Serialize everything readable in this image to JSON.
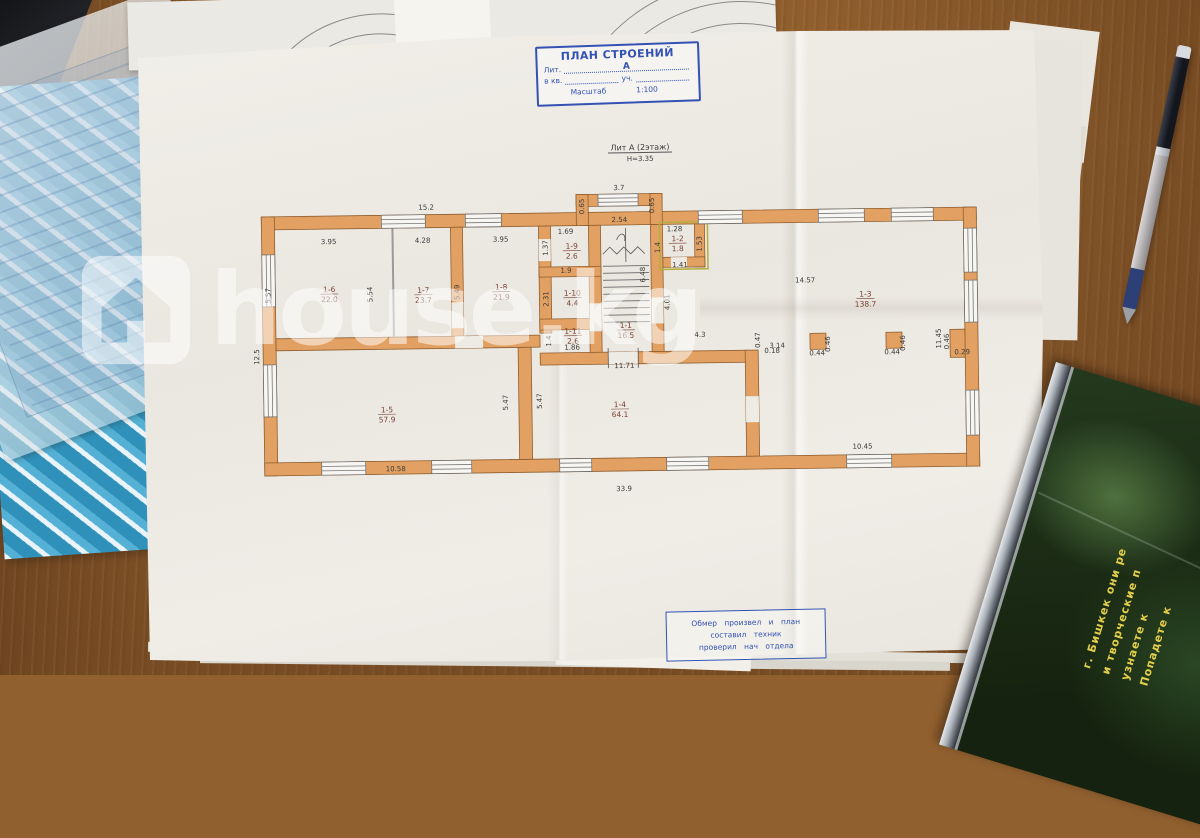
{
  "colors": {
    "wall_orange": "#E2A163",
    "ink_blue": "#3352B4",
    "dimension_text": "#3B3B3B",
    "room_text": "#7A4034",
    "folder_blue": "#2F91BA",
    "cd_text_yellow": "#E3CF4B",
    "desk_wood": "#91602F",
    "watermark_white": "rgba(255,255,255,0.52)"
  },
  "watermark": {
    "text": "house.kg",
    "icon": "house-icon"
  },
  "title_block": {
    "title": "ПЛАН СТРОЕНИЙ",
    "lit_label": "Лит.",
    "lit_value": "А",
    "kv_label": "в кв.",
    "uch_label": "уч.",
    "scale_label": "Масштаб",
    "scale_value": "1:100"
  },
  "plan_heading": {
    "line1": "Лит А (2этаж)",
    "line2": "Н=3.35"
  },
  "footer_block": {
    "line1": "Обмер произвел и план",
    "line2": "составил техник",
    "line3": "проверил нач отдела"
  },
  "cd_case": {
    "lines": [
      "Попадете к",
      "узнаете к",
      "и творческие п",
      "г. Бишкек они ре"
    ]
  },
  "plan": {
    "rooms": [
      {
        "id": "1-6",
        "area": "22.0",
        "x": 330,
        "y": 289
      },
      {
        "id": "1-7",
        "area": "23.7",
        "x": 424,
        "y": 291
      },
      {
        "id": "1-8",
        "area": "21.9",
        "x": 502,
        "y": 289
      },
      {
        "id": "1-9",
        "area": "2.6",
        "x": 573,
        "y": 249
      },
      {
        "id": "1-10",
        "area": "4.4",
        "x": 573,
        "y": 296
      },
      {
        "id": "1-11",
        "area": "2.6",
        "x": 573,
        "y": 334
      },
      {
        "id": "1-1",
        "area": "16.5",
        "x": 626,
        "y": 329
      },
      {
        "id": "1-2",
        "area": "1.8",
        "x": 679,
        "y": 243
      },
      {
        "id": "1-3",
        "area": "138.7",
        "x": 866,
        "y": 301
      },
      {
        "id": "1-5",
        "area": "57.9",
        "x": 386,
        "y": 410
      },
      {
        "id": "1-4",
        "area": "64.1",
        "x": 619,
        "y": 408
      }
    ],
    "dimensions": [
      {
        "t": "15.2",
        "x": 428,
        "y": 207,
        "r": 0
      },
      {
        "t": "3.7",
        "x": 621,
        "y": 190,
        "r": 0
      },
      {
        "t": "0.65",
        "x": 586,
        "y": 206,
        "r": -90
      },
      {
        "t": "0.65",
        "x": 656,
        "y": 206,
        "r": -90
      },
      {
        "t": "2.54",
        "x": 621,
        "y": 222,
        "r": 0
      },
      {
        "t": "3.95",
        "x": 330,
        "y": 240,
        "r": 0
      },
      {
        "t": "4.28",
        "x": 424,
        "y": 240,
        "r": 0
      },
      {
        "t": "3.95",
        "x": 502,
        "y": 240,
        "r": 0
      },
      {
        "t": "1.69",
        "x": 567,
        "y": 233,
        "r": 0
      },
      {
        "t": "1.37",
        "x": 549,
        "y": 247,
        "r": -90
      },
      {
        "t": "1.9",
        "x": 567,
        "y": 272,
        "r": 0
      },
      {
        "t": "2.31",
        "x": 549,
        "y": 298,
        "r": -90
      },
      {
        "t": "5.57",
        "x": 271,
        "y": 291,
        "r": -90
      },
      {
        "t": "5.54",
        "x": 373,
        "y": 291,
        "r": -90
      },
      {
        "t": "5.49",
        "x": 460,
        "y": 290,
        "r": -90
      },
      {
        "t": "12.5",
        "x": 259,
        "y": 352,
        "r": -90
      },
      {
        "t": "1.28",
        "x": 676,
        "y": 232,
        "r": 0
      },
      {
        "t": "1.4",
        "x": 661,
        "y": 248,
        "r": -90
      },
      {
        "t": "1.53",
        "x": 703,
        "y": 245,
        "r": -90
      },
      {
        "t": "1.41",
        "x": 681,
        "y": 268,
        "r": 0
      },
      {
        "t": "6.48",
        "x": 646,
        "y": 275,
        "r": -90
      },
      {
        "t": "4.01",
        "x": 670,
        "y": 303,
        "r": -90
      },
      {
        "t": "14.57",
        "x": 806,
        "y": 285,
        "r": 0
      },
      {
        "t": "11.45",
        "x": 941,
        "y": 343,
        "r": -90
      },
      {
        "t": "0.46",
        "x": 830,
        "y": 347,
        "r": -90
      },
      {
        "t": "0.44",
        "x": 817,
        "y": 358,
        "r": 0
      },
      {
        "t": "0.46",
        "x": 905,
        "y": 347,
        "r": -90
      },
      {
        "t": "0.44",
        "x": 892,
        "y": 358,
        "r": 0
      },
      {
        "t": "0.46",
        "x": 949,
        "y": 346,
        "r": -90
      },
      {
        "t": "0.29",
        "x": 962,
        "y": 359,
        "r": 0
      },
      {
        "t": "3.14",
        "x": 777,
        "y": 350,
        "r": 0
      },
      {
        "t": "4.3",
        "x": 700,
        "y": 338,
        "r": 0
      },
      {
        "t": "0.47",
        "x": 760,
        "y": 342,
        "r": -90
      },
      {
        "t": "0.18",
        "x": 772,
        "y": 355,
        "r": 0
      },
      {
        "t": "11.71",
        "x": 624,
        "y": 368,
        "r": 0
      },
      {
        "t": "1.86",
        "x": 572,
        "y": 349,
        "r": 0
      },
      {
        "t": "1.4",
        "x": 551,
        "y": 340,
        "r": -90
      },
      {
        "t": "5.47",
        "x": 507,
        "y": 401,
        "r": -90
      },
      {
        "t": "5.47",
        "x": 541,
        "y": 400,
        "r": -90
      },
      {
        "t": "10.58",
        "x": 394,
        "y": 468,
        "r": 0
      },
      {
        "t": "33.9",
        "x": 622,
        "y": 491,
        "r": 0
      },
      {
        "t": "10.45",
        "x": 861,
        "y": 452,
        "r": 0
      }
    ]
  }
}
